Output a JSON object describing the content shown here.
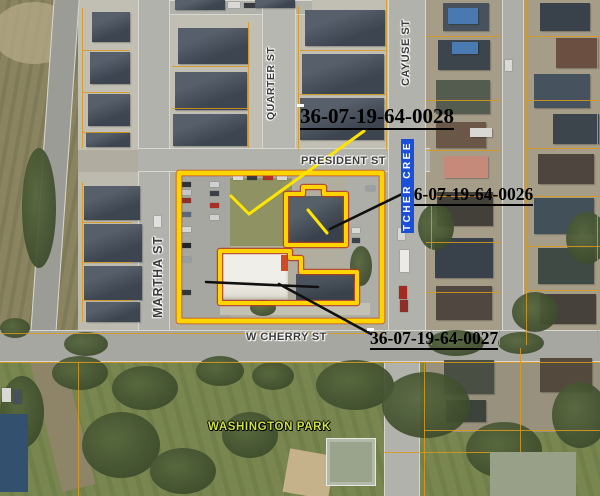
{
  "map": {
    "parcel_labels": [
      {
        "id": "0028",
        "text": "36-07-19-64-0028"
      },
      {
        "id": "0026",
        "text": "36-07-19-64-0026"
      },
      {
        "id": "0027",
        "text": "36-07-19-64-0027"
      }
    ],
    "street_labels": {
      "quarter": "QUARTER ST",
      "cayuse": "CAYUSE ST",
      "president": "PRESIDENT ST",
      "martha": "MARTHA ST",
      "cherry": "W CHERRY ST"
    },
    "creek_label": "TCHER CREE",
    "park_label": "WASHINGTON PARK",
    "colors": {
      "parcel_highlight": "#FFD400",
      "parcel_line": "#D99A1C",
      "label_bg": "#FFFFFF",
      "label_text": "#000000",
      "street_text": "#3C3C3C",
      "park_text": "#CDE23C",
      "creek_bg": "#1C4FD8",
      "creek_text": "#FFFFFF"
    }
  }
}
